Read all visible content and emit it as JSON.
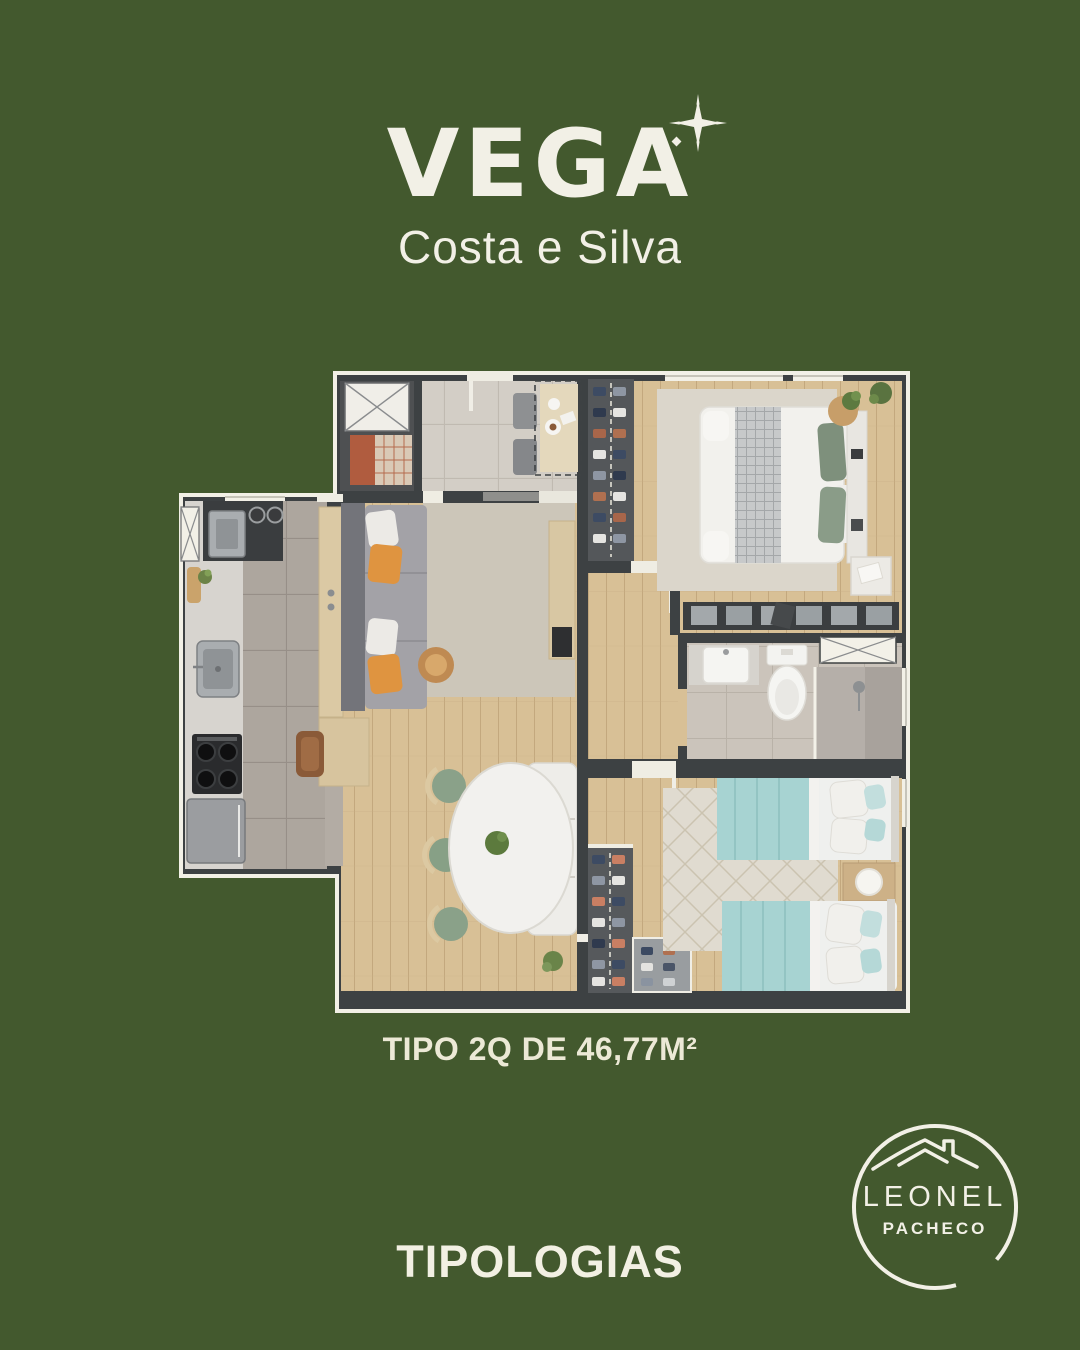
{
  "page": {
    "background": "#43592e"
  },
  "brand": {
    "name": "VEGA",
    "subtitle": "Costa e Silva"
  },
  "icons": {
    "sparkle": "four-point-star",
    "roofline": "house-roof-with-chimney"
  },
  "plan": {
    "caption": "TIPO 2Q DE 46,77M²"
  },
  "footer": {
    "title": "TIPOLOGIAS"
  },
  "agency": {
    "name": "LEONEL",
    "subname": "PACHECO"
  },
  "palette": {
    "background_green": "#43592e",
    "cream": "#f2f0e6",
    "wall_dark": "#3d4143",
    "wood_floor": "#d8c096",
    "kitchen_tile": "#ada69e",
    "entry_tile": "#d3cec6",
    "bath_tile": "#cbc4bb",
    "rug_living": "#ccc6b9",
    "rug_bedroom1": "#dbd6cb",
    "rug_bedroom2": "#e0dbd0",
    "sofa_gray": "#a3a2a7",
    "pillow_orange": "#df9440",
    "chair_green": "#8aa189",
    "bed_teal": "#a7d3d2",
    "laundry_terracotta": "#b05c3f"
  }
}
